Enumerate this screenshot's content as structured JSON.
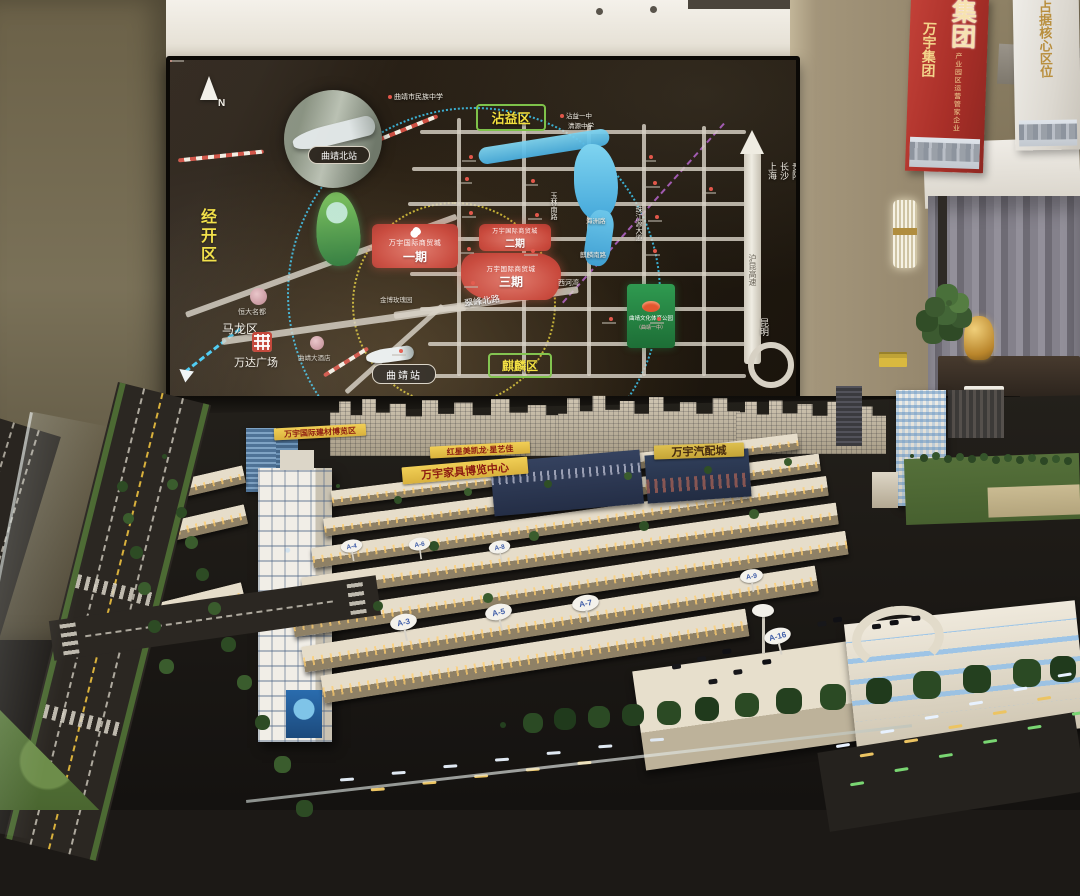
{
  "banners": {
    "red": {
      "big": "集团",
      "title": "万宇集团",
      "subtitle": "产业园区运营管家企业"
    },
    "white": {
      "title": "占据核心区位"
    }
  },
  "map": {
    "compass": "N",
    "districts": {
      "jingkai": "经开区",
      "zhanyi": "沾益区",
      "qilin": "麒麟区",
      "malong": "马龙区"
    },
    "stations": {
      "north": "曲靖北站",
      "main": "曲靖站"
    },
    "project": {
      "brand": "万宇国际商贸城",
      "phase1": "一期",
      "phase2": "二期",
      "phase3": "三期"
    },
    "roads": {
      "cuifeng": "翠峰北路",
      "yulin": "玉林南路",
      "zhujiang": "珠江源大道",
      "hukun": "沪昆高速",
      "qilin_s": "麒麟南路",
      "haizhou": "海洲路"
    },
    "cities": {
      "shanghai": "上海",
      "changsha": "长沙",
      "guiyang": "贵阳",
      "kunming": "昆明"
    },
    "pois": {
      "minzu": "曲靖市民族中学",
      "zhanyi1": "沾益一中",
      "qingyuan": "清源中学",
      "wanda": "万达广场",
      "hengda": "恒大名都",
      "jinbo": "金博玫瑰园",
      "xihewan": "西河湾",
      "hotel": "曲靖大酒店",
      "park": "曲靖文化体育公园",
      "park2": "（曲靖一中）"
    }
  },
  "model": {
    "signs": {
      "building_mat": "万宇国际建材博览区",
      "redstar": "红星美凯龙·星艺佳",
      "furniture": "万宇家具博览中心",
      "auto": "万宇汽配城"
    },
    "lots": [
      "A-4",
      "A-6",
      "A-8",
      "A-3",
      "A-5",
      "A-7",
      "A-9",
      "A-16"
    ]
  },
  "colors": {
    "accent_red": "#c8473a",
    "district_yellow": "#f2df3d",
    "map_cyan": "#3fc8f2",
    "banner_red": "#b5352c",
    "sign_yellow": "#e5c04a"
  }
}
